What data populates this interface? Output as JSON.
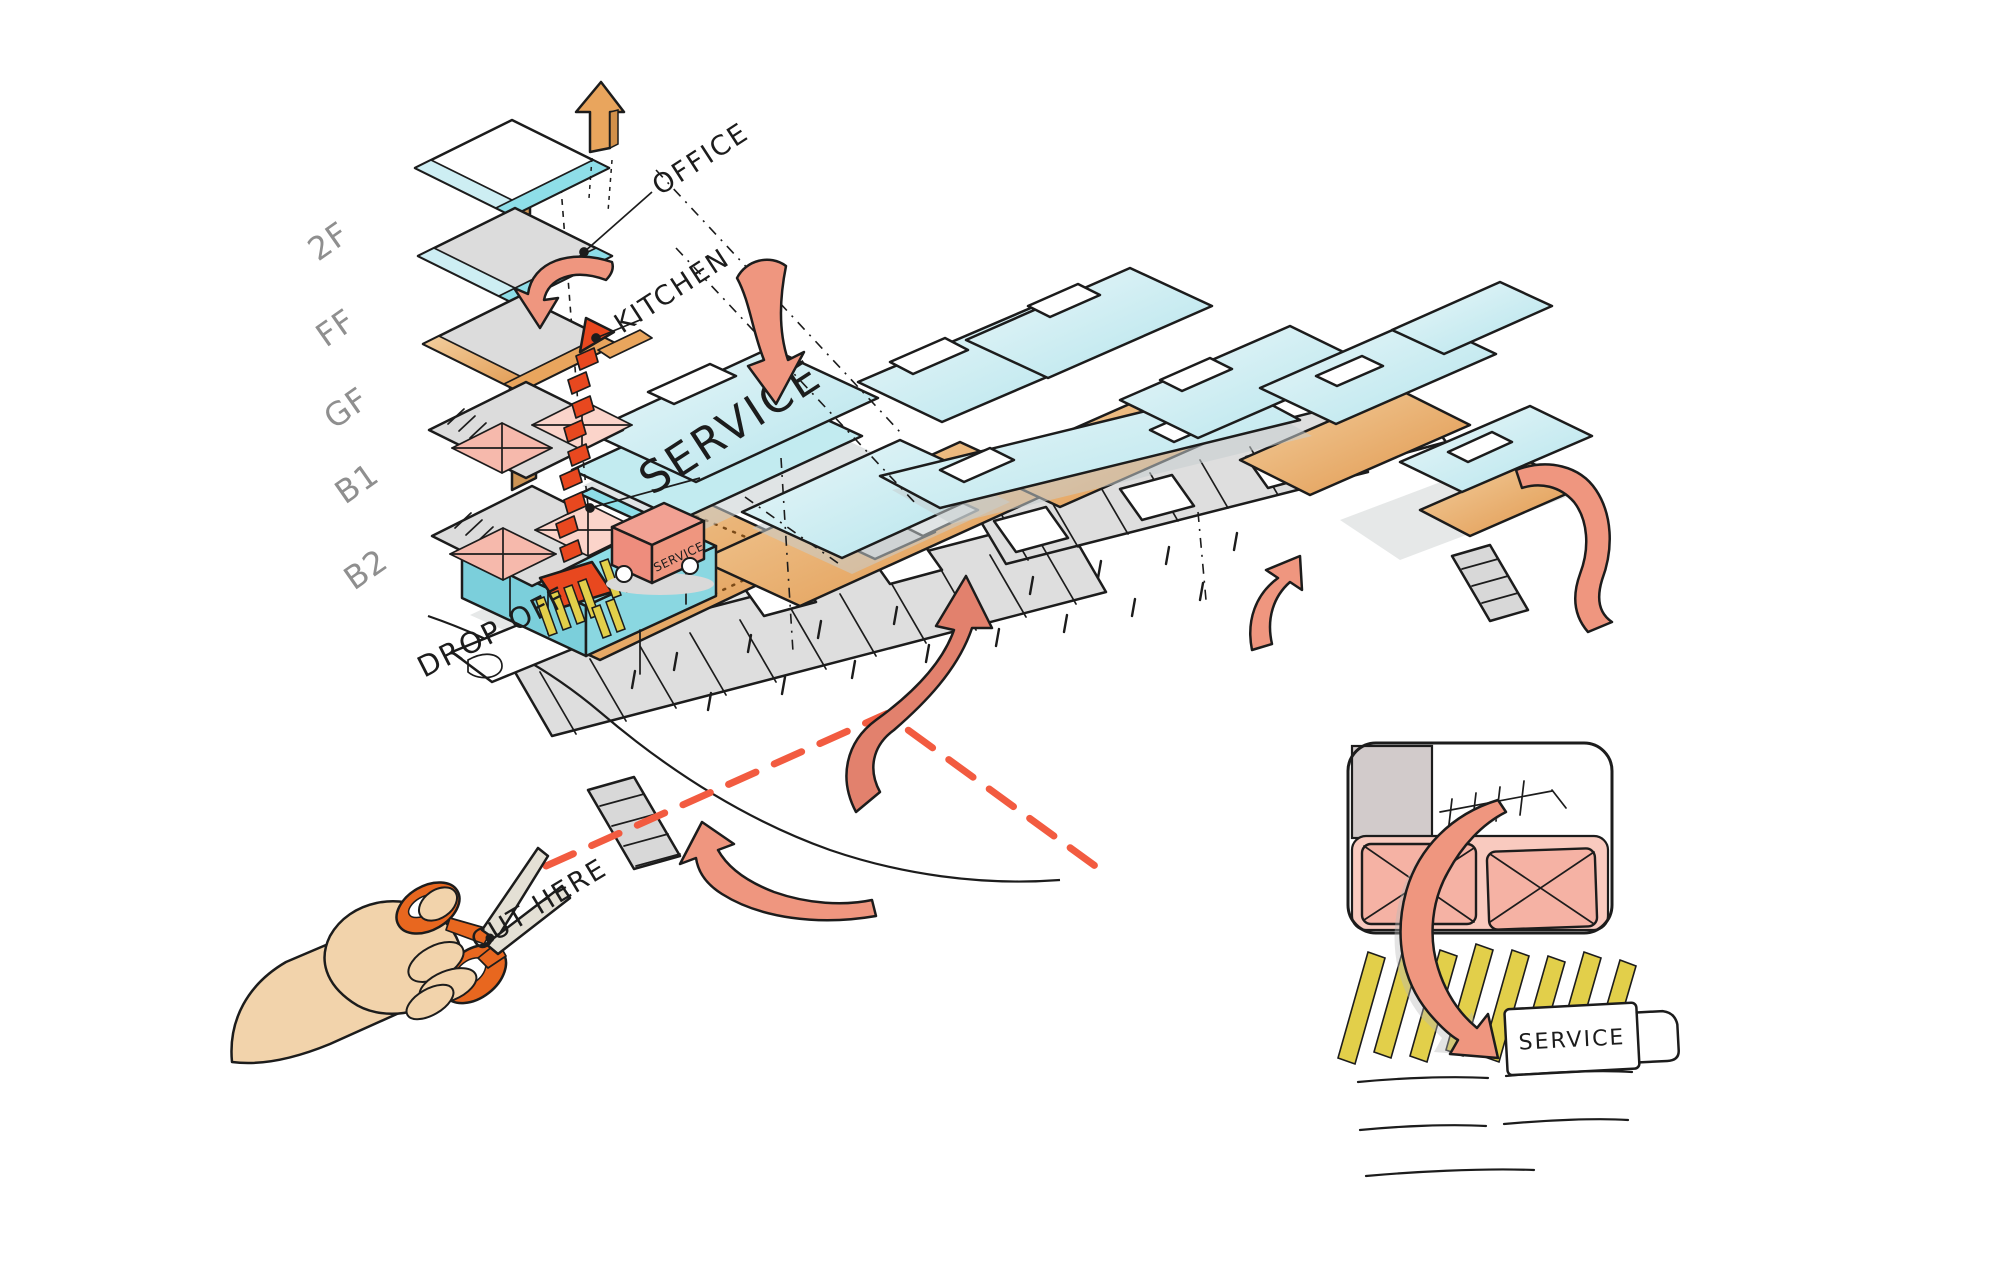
{
  "colors": {
    "ink": "#1c1c1c",
    "gray-text": "#8f8f8f",
    "plate-gray": "#dcdcdc",
    "ground-gray": "#dedede",
    "cyan": "#8edee8",
    "cyan-pale": "#cdeef3",
    "cyan-deep": "#7bcfdb",
    "orange": "#e9a55d",
    "orange-deep": "#d2904a",
    "core-brown": "#cd9454",
    "pink": "#f6b9ac",
    "pink-light": "#fbd4ca",
    "salmon": "#ef967f",
    "salmon-dark": "#e2816d",
    "red": "#e8481f",
    "red-dash": "#f25b40",
    "yellow": "#e2cf4a",
    "skin": "#f2d3ab",
    "handle-orange": "#e8671f",
    "blade": "#e4e0d5"
  },
  "stack": {
    "floors": [
      "2F",
      "FF",
      "GF",
      "B1",
      "B2"
    ],
    "program_labels": {
      "office": "OFFICE",
      "kitchen": "KITCHEN",
      "service": "SERVICE"
    },
    "drop_off_label": "DROP OFF",
    "truck_label": "SERVICE"
  },
  "site": {
    "cut_here_label": "CUT HERE"
  },
  "inset": {
    "truck_label": "SERVICE"
  }
}
